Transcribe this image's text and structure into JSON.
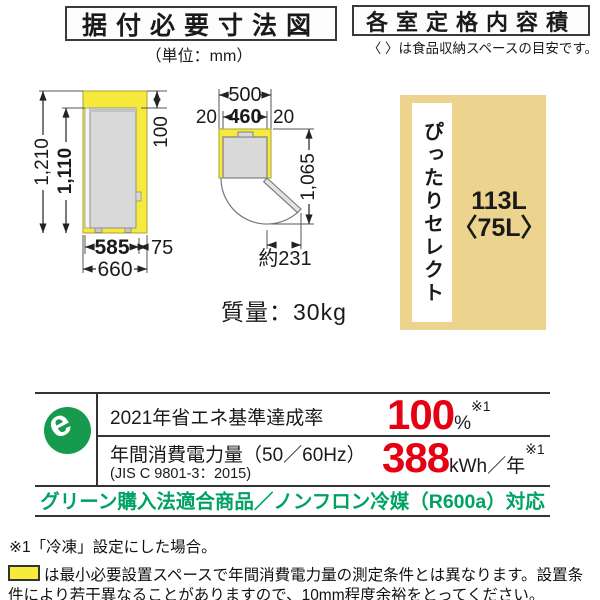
{
  "headers": {
    "installation": {
      "title": "据付必要寸法図",
      "unit_note": "（単位：mm）"
    },
    "capacity": {
      "title": "各室定格内容積",
      "note": "〈 〉は食品収納スペースの目安です。"
    }
  },
  "front_view": {
    "total_height": "1,210",
    "body_height": "1,110",
    "top_clearance": "100",
    "body_width": "585",
    "side_clearance": "75",
    "total_width": "660"
  },
  "top_view": {
    "total_width": "500",
    "left_clearance": "20",
    "body_width": "460",
    "right_clearance": "20",
    "door_open_depth": "1,065",
    "door_protrusion": "約231"
  },
  "weight_label": "質量：30kg",
  "capacity_box": {
    "compartment_name": "ぴったりセレクト",
    "capacity": "113L",
    "storage_space": "〈75L〉"
  },
  "energy_label": {
    "emark_letter": "e",
    "standard_achievement": {
      "label": "2021年省エネ基準達成率",
      "value": "100",
      "unit": "%",
      "footnote_ref": "※1"
    },
    "annual_consumption": {
      "label": "年間消費電力量（50／60Hz）",
      "sublabel": "(JIS C 9801-3：2015)",
      "value": "388",
      "unit": "kWh／年",
      "footnote_ref": "※1"
    },
    "green_note": "グリーン購入法適合商品／ノンフロン冷媒（R600a）対応"
  },
  "footnotes": {
    "note1": "※1「冷凍」設定にした場合。",
    "note2": "は最小必要設置スペースで年間消費電力量の測定条件とは異なります。設置条件により若干異なることがありますので、10mm程度余裕をとってください。"
  },
  "colors": {
    "clearance_yellow": "#f6eb3d",
    "capacity_tan": "#ecd48f",
    "value_red": "#e60012",
    "eco_green": "#00a263",
    "emark_green": "#169a4e"
  }
}
